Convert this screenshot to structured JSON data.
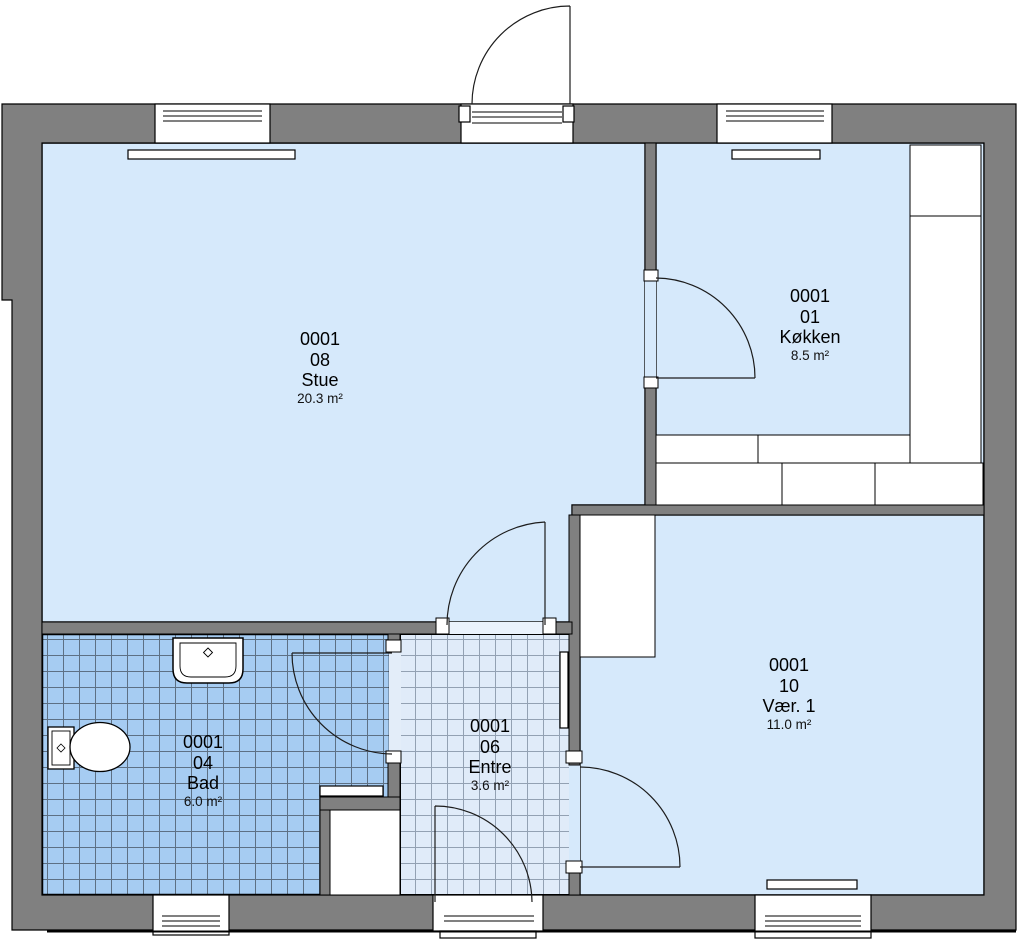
{
  "plan": {
    "rooms": [
      {
        "key": "stue",
        "unit": "0001",
        "number": "08",
        "name": "Stue",
        "area": "20.3 m²"
      },
      {
        "key": "kokken",
        "unit": "0001",
        "number": "01",
        "name": "Køkken",
        "area": "8.5 m²"
      },
      {
        "key": "vaer1",
        "unit": "0001",
        "number": "10",
        "name": "Vær. 1",
        "area": "11.0 m²"
      },
      {
        "key": "entre",
        "unit": "0001",
        "number": "06",
        "name": "Entre",
        "area": "3.6 m²"
      },
      {
        "key": "bad",
        "unit": "0001",
        "number": "04",
        "name": "Bad",
        "area": "6.0 m²"
      }
    ],
    "colors": {
      "wall": "#808080",
      "room_fill": "#d6e9fb",
      "bad_tile_fill": "#a6ccf2",
      "bad_tile_grid": "#5d7084",
      "entre_tile_fill": "#e0ebf9",
      "entre_tile_grid": "#93a1b3",
      "line": "#000000",
      "fixture_fill": "#ffffff"
    }
  }
}
